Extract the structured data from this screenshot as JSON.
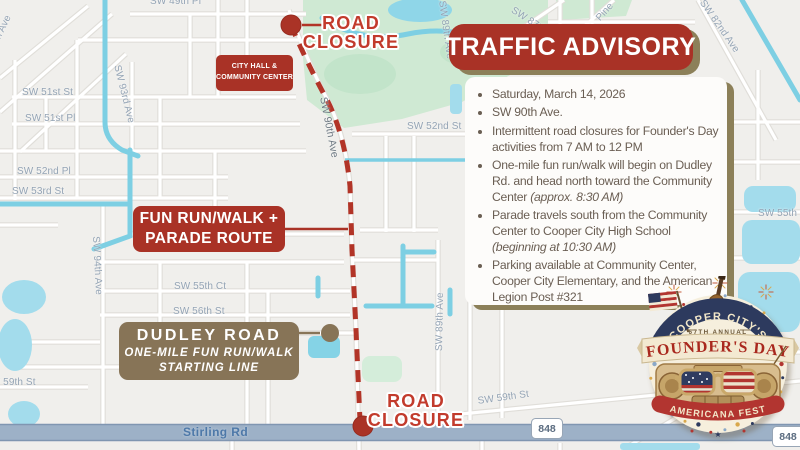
{
  "colors": {
    "accent_red": "#a93226",
    "route_red": "#b23427",
    "closure_red": "#c23b2c",
    "tan": "#877457",
    "shadow_tan": "#8c8059",
    "text_brown": "#6a5e53",
    "water": "#7dcfe3",
    "park_green": "#cfe9d3",
    "road_band": "#9db1c7"
  },
  "advisory": {
    "title": "TRAFFIC ADVISORY",
    "bullets": [
      {
        "text": "Saturday, March 14, 2026"
      },
      {
        "text": "SW 90th Ave."
      },
      {
        "text": "Intermittent road closures for Founder's Day activities from 7 AM to 12 PM"
      },
      {
        "text": "One-mile fun run/walk will begin on Dudley Rd. and head north toward the Community Center ",
        "italic": "(approx. 8:30 AM)"
      },
      {
        "text": "Parade travels south from the Community Center to Cooper City High School ",
        "italic": "(beginning at 10:30 AM)"
      },
      {
        "text": "Parking available at Community Center, Cooper City Elementary, and the American Legion Post #321"
      }
    ]
  },
  "annotations": {
    "road_closure_top": {
      "line1": "ROAD",
      "line2": "CLOSURE"
    },
    "road_closure_bottom": {
      "line1": "ROAD",
      "line2": "CLOSURE"
    },
    "city_hall": {
      "line1": "CITY HALL &",
      "line2": "COMMUNITY CENTER"
    },
    "fun_run": {
      "line1": "FUN RUN/WALK +",
      "line2": "PARADE ROUTE"
    },
    "dudley": {
      "title": "DUDLEY ROAD",
      "line2": "ONE-MILE FUN RUN/WALK",
      "line3": "STARTING LINE"
    }
  },
  "map": {
    "highway_badge": "848",
    "main_road": "Stirling Rd",
    "street_labels": [
      {
        "text": "SW 49th Pl",
        "x": 150,
        "y": -4,
        "r": 0
      },
      {
        "text": "SW 51st St",
        "x": 22,
        "y": 87,
        "r": 0
      },
      {
        "text": "SW 51st Pl",
        "x": 25,
        "y": 113,
        "r": 0
      },
      {
        "text": "SW 52nd Pl",
        "x": 17,
        "y": 166,
        "r": 0
      },
      {
        "text": "SW 53rd St",
        "x": 12,
        "y": 186,
        "r": 0
      },
      {
        "text": "SW 55th Ct",
        "x": 174,
        "y": 281,
        "r": 0
      },
      {
        "text": "SW 56th St",
        "x": 173,
        "y": 306,
        "r": 0
      },
      {
        "text": "SW 52nd St",
        "x": 407,
        "y": 121,
        "r": 0
      },
      {
        "text": "SW 55th St",
        "x": 758,
        "y": 208,
        "r": 0
      },
      {
        "text": "SW 59th St",
        "x": -16,
        "y": 377,
        "r": 0
      },
      {
        "text": "SW 59th St",
        "x": 477,
        "y": 396,
        "r": -8
      },
      {
        "text": "SW 93rd Ave",
        "x": 122,
        "y": 64,
        "r": 76
      },
      {
        "text": "SW 94th Ave",
        "x": 101,
        "y": 236,
        "r": 87
      },
      {
        "text": "SW 90th Ave",
        "x": 329,
        "y": 96,
        "r": 79,
        "cls": "ave90"
      },
      {
        "text": "SW 89th Ave",
        "x": 434,
        "y": 351,
        "r": -89
      },
      {
        "text": "SW 89th Ave",
        "x": 447,
        "y": 0,
        "r": 82
      },
      {
        "text": "SW 87th Ave",
        "x": 515,
        "y": 5,
        "r": 33
      },
      {
        "text": "Pine",
        "x": 594,
        "y": 16,
        "r": -48
      },
      {
        "text": "SW 82nd Ave",
        "x": 706,
        "y": -2,
        "r": 55
      },
      {
        "text": "Palm Ave",
        "x": -15,
        "y": 52,
        "r": -64
      }
    ]
  },
  "logo": {
    "top_arc": "COOPER CITY'S",
    "annual": "67TH ANNUAL",
    "title": "FOUNDER'S DAY",
    "bottom_arc": "AMERICANA FEST"
  }
}
